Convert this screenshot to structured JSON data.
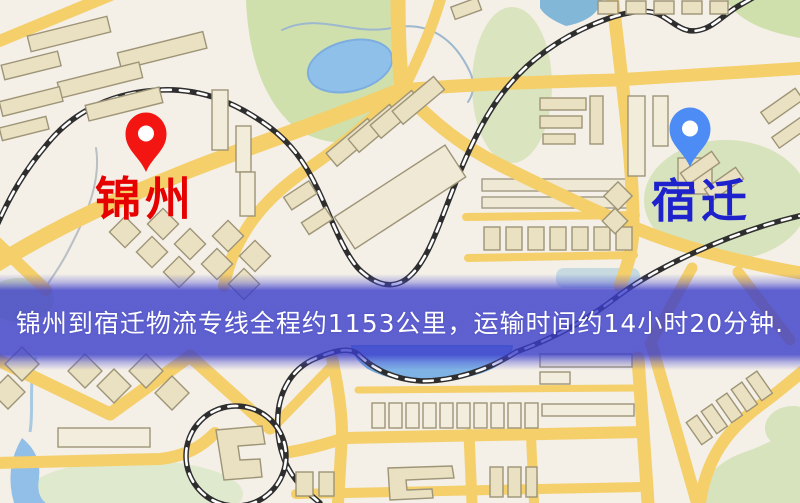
{
  "map": {
    "markers": {
      "origin": {
        "label": "锦州",
        "pin_color": "#f21511",
        "label_color": "#e60000"
      },
      "destination": {
        "label": "宿迁",
        "pin_color": "#4e8cf5",
        "label_color": "#1e22cc"
      }
    },
    "banner": {
      "text": "锦州到宿迁物流专线全程约1153公里，运输时间约14小时20分钟.",
      "background_color": "#3a3dcb",
      "text_color": "#ffffff"
    },
    "route": {
      "from": "锦州",
      "to": "宿迁",
      "distance_text": "约1153公里",
      "duration_text": "约14小时20分钟"
    },
    "palette": {
      "background": "#f4efe7",
      "road": "#f4cf6a",
      "building": "#eae1c2",
      "park": "#cfe0ad",
      "water": "#8fc0ea",
      "railway": "#2e2e2e"
    }
  }
}
